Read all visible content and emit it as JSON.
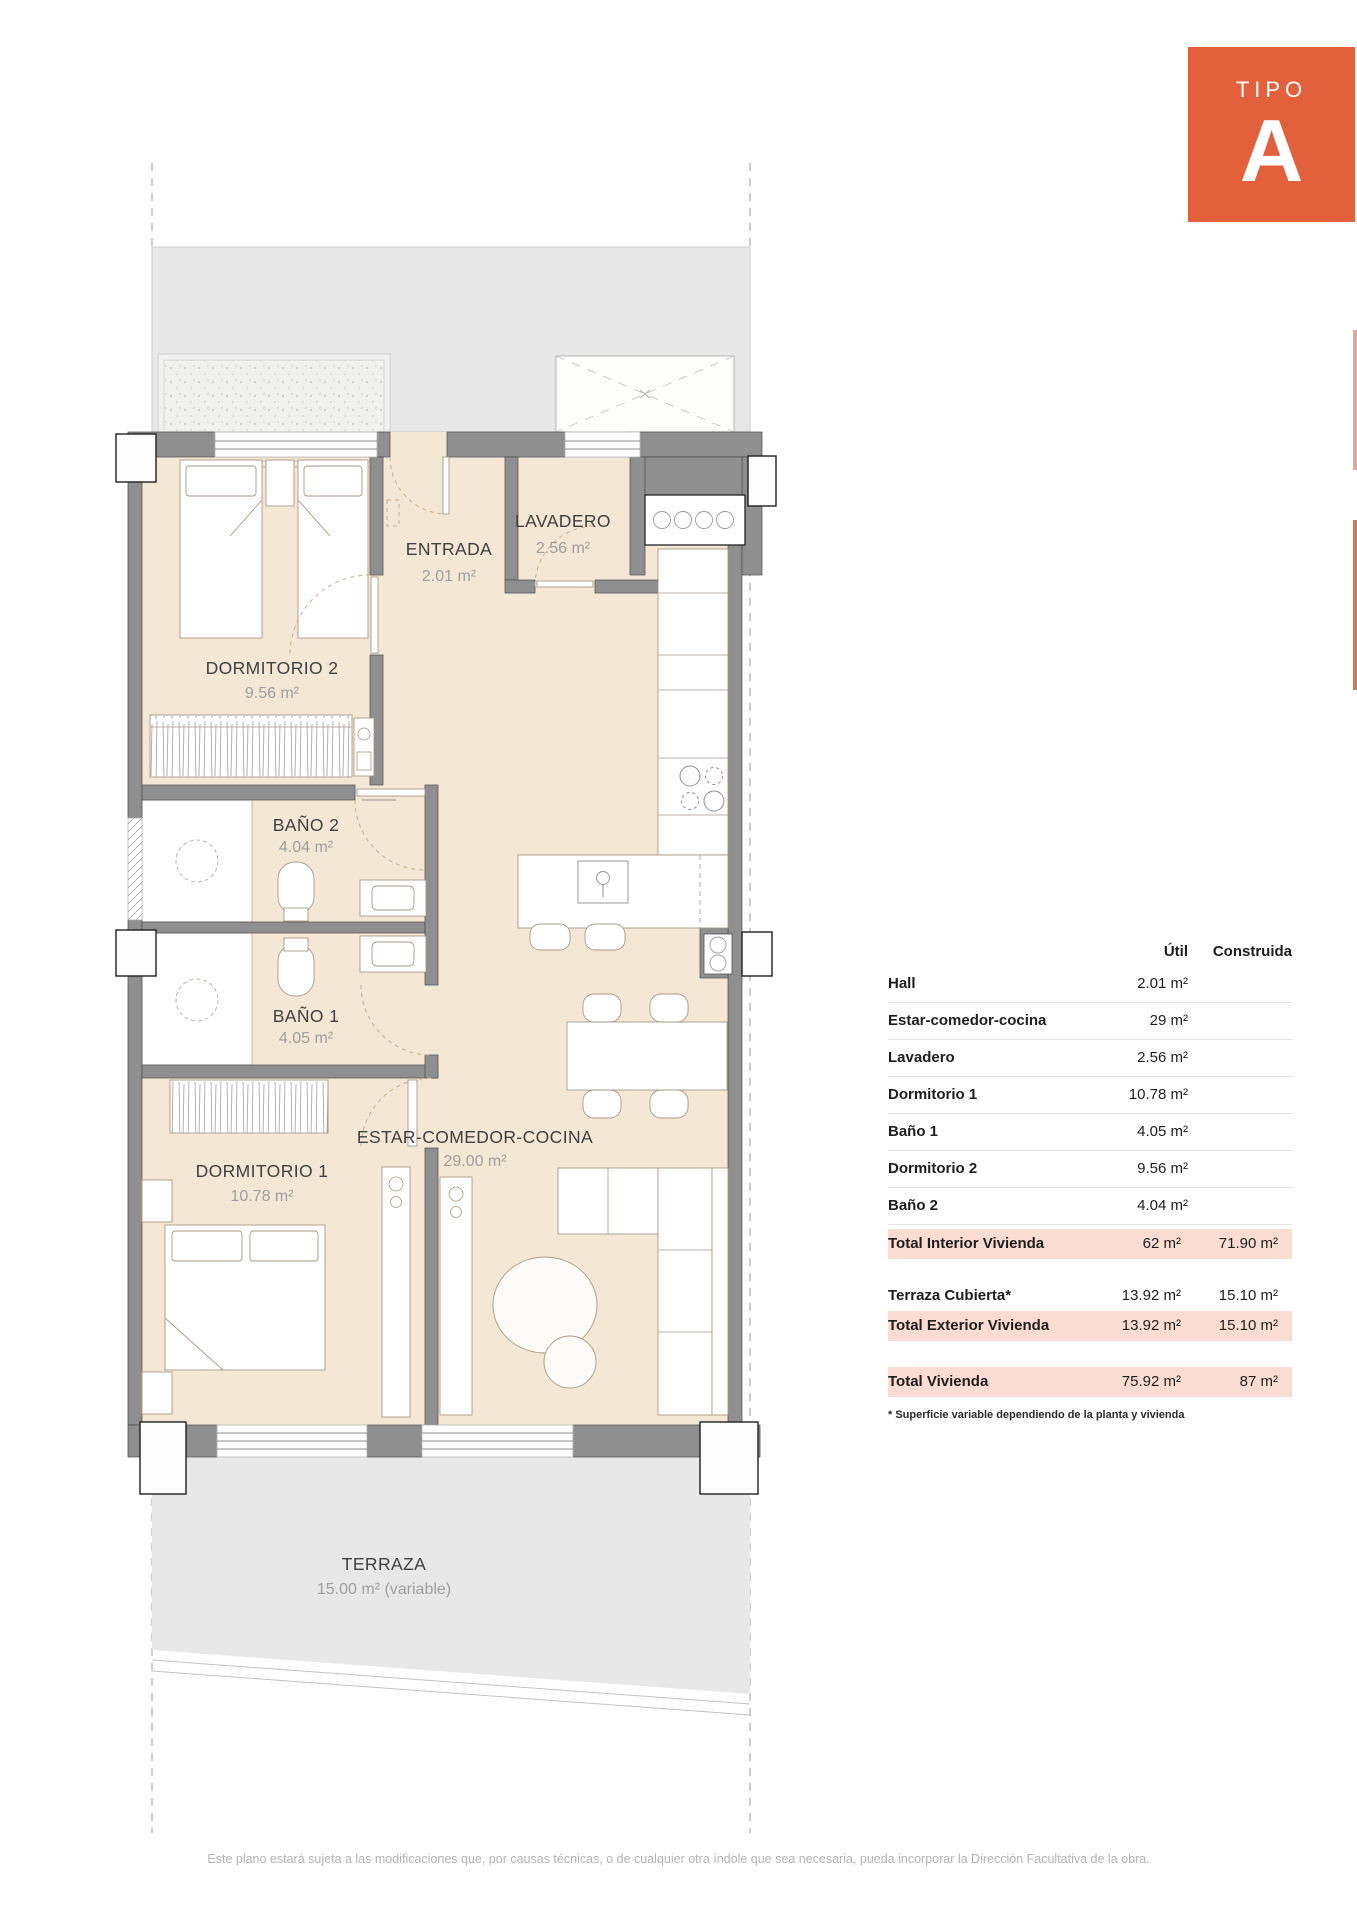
{
  "badge": {
    "label": "TIPO",
    "letter": "A"
  },
  "plan": {
    "rooms": [
      {
        "id": "dormitorio-2",
        "name": "DORMITORIO 2",
        "area": "9.56 m²"
      },
      {
        "id": "entrada",
        "name": "ENTRADA",
        "area": "2.01 m²"
      },
      {
        "id": "lavadero",
        "name": "LAVADERO",
        "area": "2.56 m²"
      },
      {
        "id": "bano-2",
        "name": "BAÑO 2",
        "area": "4.04 m²"
      },
      {
        "id": "bano-1",
        "name": "BAÑO 1",
        "area": "4.05 m²"
      },
      {
        "id": "dormitorio-1",
        "name": "DORMITORIO 1",
        "area": "10.78 m²"
      },
      {
        "id": "estar",
        "name": "ESTAR-COMEDOR-COCINA",
        "area": "29.00 m²"
      },
      {
        "id": "terraza",
        "name": "TERRAZA",
        "area": "15.00 m² (variable)"
      }
    ]
  },
  "table": {
    "headers": {
      "util": "Útil",
      "construida": "Construida"
    },
    "rows": [
      {
        "label": "Hall",
        "util": "2.01 m²",
        "construida": ""
      },
      {
        "label": "Estar-comedor-cocina",
        "util": "29 m²",
        "construida": ""
      },
      {
        "label": "Lavadero",
        "util": "2.56 m²",
        "construida": ""
      },
      {
        "label": "Dormitorio 1",
        "util": "10.78 m²",
        "construida": ""
      },
      {
        "label": "Baño 1",
        "util": "4.05 m²",
        "construida": ""
      },
      {
        "label": "Dormitorio 2",
        "util": "9.56 m²",
        "construida": ""
      },
      {
        "label": "Baño 2",
        "util": "4.04 m²",
        "construida": ""
      }
    ],
    "totals": [
      {
        "label": "Total Interior Vivienda",
        "util": "62 m²",
        "construida": "71.90 m²"
      },
      {
        "label": "Terraza Cubierta*",
        "util": "13.92 m²",
        "construida": "15.10 m²"
      },
      {
        "label": "Total Exterior Vivienda",
        "util": "13.92 m²",
        "construida": "15.10 m²"
      },
      {
        "label": "Total Vivienda",
        "util": "75.92 m²",
        "construida": "87 m²"
      }
    ],
    "footnote": "* Superficie variable dependiendo de la planta y vivienda"
  },
  "footer": {
    "text": "Este plano estará sujeta a las modificaciones que, por causas técnicas, o de cualquier otra índole que sea necesaria, pueda incorporar la Dirección Facultativa de la obra."
  },
  "colors": {
    "accent": "#e2603c",
    "highlight": "#fadcd2",
    "wall": "#8f8f8f",
    "floor": "#f4e7d5",
    "exterior": "#e8e8e8"
  }
}
